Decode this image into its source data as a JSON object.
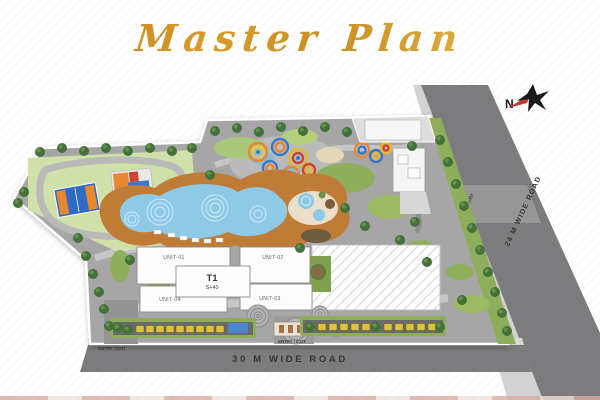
{
  "title": "Master Plan",
  "compass": {
    "north_label": "N"
  },
  "roads": {
    "bottom_label": "30 M WIDE ROAD",
    "side_label": "24 M WIDE ROAD"
  },
  "tower": {
    "name": "T1",
    "floors": "S+40",
    "units": {
      "u1": "UNIT-01",
      "u2": "UNIT-02",
      "u3": "UNIT-03",
      "u4": "UNIT-04"
    }
  },
  "entries": {
    "bottom_left": "ENTRY / EXIT",
    "bottom_center": "ENTRY / EXIT",
    "side_road": "ENTRY / EXIT"
  },
  "colors": {
    "gold_dark": "#b97817",
    "gold_light": "#edc75f",
    "road": "#7c7c7e",
    "ground": "#a6a6a6",
    "pool_water": "#8ecae5",
    "pool_deck": "#c07c36",
    "lawn": "#a9c77a",
    "tree": "#44703a"
  }
}
